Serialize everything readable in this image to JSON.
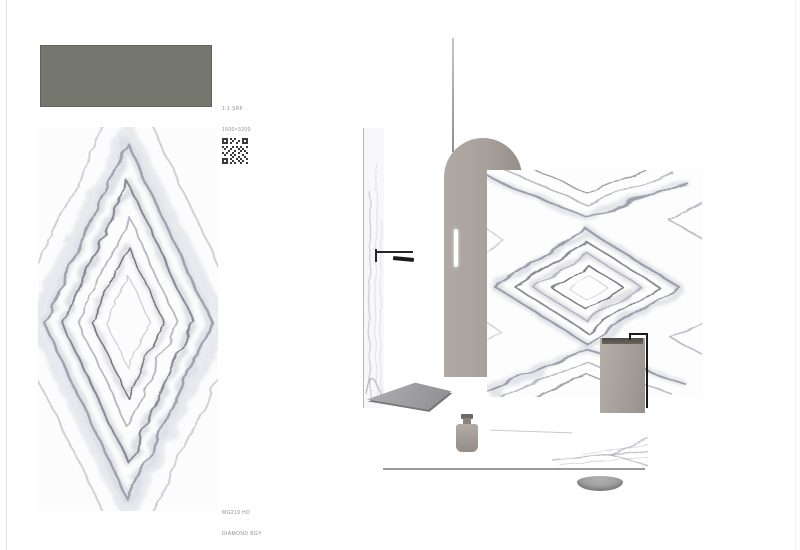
{
  "page": {
    "background": "#ffffff",
    "edge_line_color": "#dedede"
  },
  "product": {
    "swatch": {
      "color": "#75776f",
      "caption": [
        "1:1 SRF",
        "1600×3200"
      ]
    },
    "qr": {
      "icon": "qr-code"
    },
    "slab": {
      "caption": [
        "MG219 HD",
        "DIAMOND BGY"
      ],
      "marble": {
        "base": "#fcfcfd",
        "vein_dark": "#696b76",
        "vein_mid": "#8d8f9c",
        "vein_light": "#b4b6c2"
      }
    }
  },
  "scene": {
    "arch_color": "#a8a09a",
    "taupe_color": "#a49c96",
    "fixture_color": "#1d1d1f",
    "floor_line_color": "#9a9a9a",
    "objects": [
      "ceiling-pole",
      "shower-glass-panel",
      "shower-arm",
      "arch-column",
      "led-strip",
      "marble-feature-wall",
      "shower-tray",
      "decor-vase",
      "pedestal-basin",
      "floor-faucet",
      "floor-edge-line",
      "floor-marble-reflection",
      "soap-dish"
    ]
  }
}
